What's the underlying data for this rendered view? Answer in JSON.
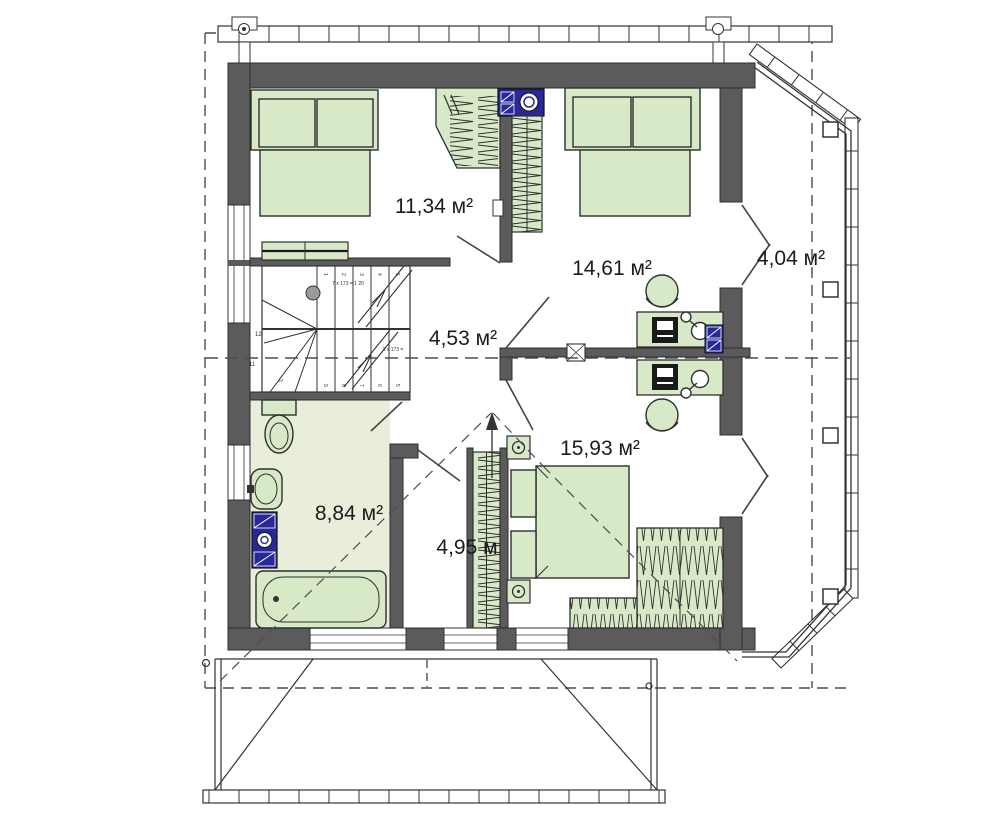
{
  "plan": {
    "type": "floor-plan",
    "floor_labels": {
      "room1": "11,34 м²",
      "room2": "14,61 м²",
      "balcony": "4,04 м²",
      "hall": "4,53 м²",
      "bedroom": "15,93 м²",
      "bathroom": "8,84 м²",
      "corridor": "4,95 м"
    },
    "stairs": {
      "note_upper": "7 x 173 = 1 20",
      "note_lower": "3 x 173 =",
      "upper_numbers": [
        "1",
        "2",
        "3",
        "4",
        "5"
      ],
      "lower_numbers": [
        "9",
        "8",
        "7",
        "6",
        "5"
      ],
      "winder_numbers": [
        "12",
        "11",
        "2"
      ]
    },
    "colors": {
      "wall": "#5b5b5b",
      "furniture_fill": "#d8e9c8",
      "bathroom_floor": "#e9eedb",
      "chimney_blue": "#28289a",
      "line": "#333333"
    }
  }
}
